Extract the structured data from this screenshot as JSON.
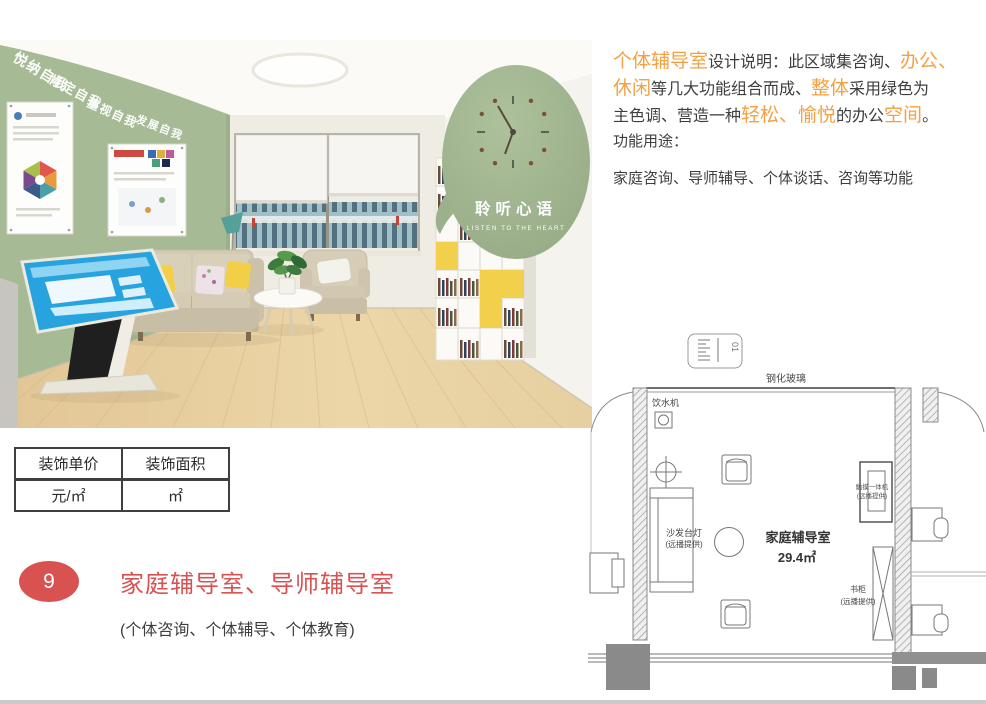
{
  "colors": {
    "accent_orange": "#F2A243",
    "accent_red": "#D95252",
    "wall_green": "#A7BA96",
    "text_dark": "#3E3E3E"
  },
  "render": {
    "slogan_words": [
      "悦纳自我",
      "肯定自我",
      "重视自我",
      "发展自我"
    ],
    "bubble_title": "聆听心语",
    "bubble_subtitle": "LISTEN TO THE HEART"
  },
  "description": {
    "l1a": "个体辅导室",
    "l1b": "设计说明：此区域集咨询、",
    "l1c": "办公、",
    "l2a": "休闲",
    "l2b": "等几大功能组合而成、",
    "l2c": "整体",
    "l2d": "采用绿色为",
    "l3a": "主色调、营造一种",
    "l3b": "轻松、愉悦",
    "l3c": "的办公",
    "l3d": "空间",
    "l3e": "。"
  },
  "usage": {
    "label": "功能用途：",
    "functions": "家庭咨询、导师辅导、个体谈话、咨询等功能"
  },
  "floor_plan": {
    "glass_label": "钢化玻璃",
    "water_dispenser": "饮水机",
    "sofa_lamp": [
      "沙发台灯",
      "(远播提供)"
    ],
    "room_name": "家庭辅导室",
    "room_area": "29.4㎡",
    "touch_machine": [
      "触摸一体机",
      "(远播提供)"
    ],
    "bookcase": [
      "书柜",
      "(远播提供)"
    ],
    "legend_mark": "01"
  },
  "pricing_table": {
    "headers": [
      "装饰单价",
      "装饰面积"
    ],
    "values": [
      "元/㎡",
      "㎡"
    ]
  },
  "section": {
    "number": "9",
    "title": "家庭辅导室、导师辅导室",
    "subtitle": "(个体咨询、个体辅导、个体教育)"
  }
}
